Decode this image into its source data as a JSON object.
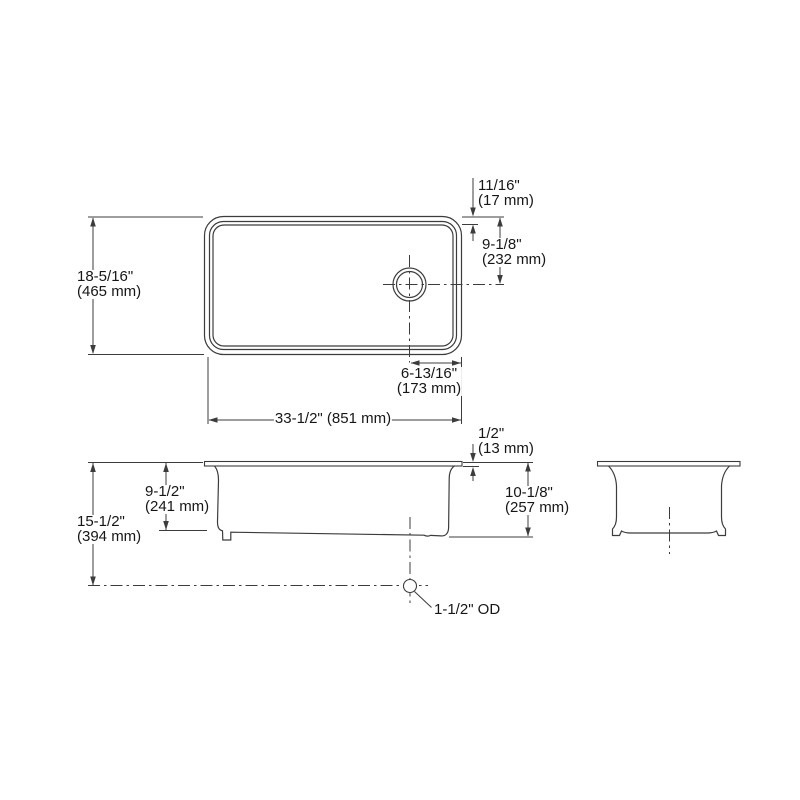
{
  "dimensions": {
    "rim_width": {
      "inches": "11/16\"",
      "metric": "(17 mm)"
    },
    "drain_center_from_back": {
      "inches": "9-1/8\"",
      "metric": "(232 mm)"
    },
    "overall_front_to_back": {
      "inches": "18-5/16\"",
      "metric": "(465 mm)"
    },
    "drain_center_from_right": {
      "inches": "6-13/16\"",
      "metric": "(173 mm)"
    },
    "overall_length": {
      "inches": "33-1/2\" (851 mm)"
    },
    "deck_thickness": {
      "inches": "1/2\"",
      "metric": "(13 mm)"
    },
    "basin_depth": {
      "inches": "9-1/2\"",
      "metric": "(241 mm)"
    },
    "rim_to_drain_centerline": {
      "inches": "15-1/2\"",
      "metric": "(394 mm)"
    },
    "overall_height": {
      "inches": "10-1/8\"",
      "metric": "(257 mm)"
    },
    "drain_outlet": {
      "label": "1-1/2\" OD"
    }
  },
  "colors": {
    "line": "#3c3c3c",
    "text": "#161616",
    "background": "#ffffff"
  }
}
